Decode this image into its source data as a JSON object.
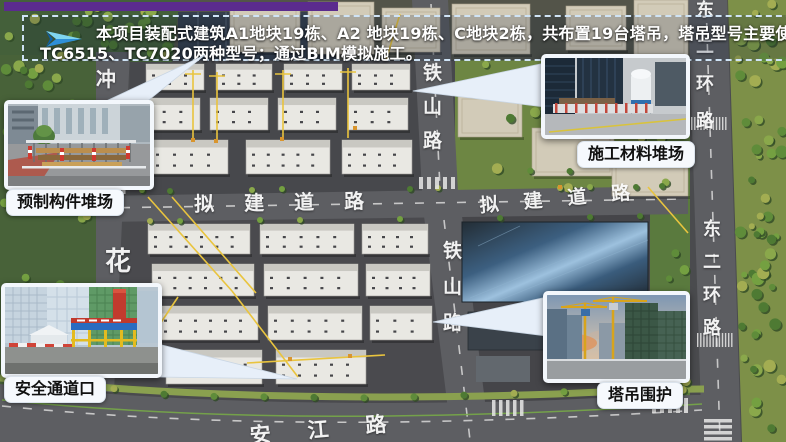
{
  "banner": {
    "icon": "blue-arrow-icon",
    "line1": "本项目装配式建筑A1地块19栋、A2 地块19栋、C地块2栋，共布置19台塔吊，塔吊型号主要使用",
    "line2": "TC6515、TC7020两种型号；通过BIM模拟施工。"
  },
  "callouts": {
    "prefab": {
      "label": "预制构件堆场"
    },
    "material": {
      "label": "施工材料堆场"
    },
    "safety": {
      "label": "安全通道口"
    },
    "crane": {
      "label": "塔吊围护"
    }
  },
  "map": {
    "road_labels": [
      {
        "id": "tieshan-north",
        "text": "铁山路",
        "vertical": true,
        "x": 423,
        "y": 64,
        "dy": 34,
        "size": 19
      },
      {
        "id": "tieshan-south",
        "text": "铁山路",
        "vertical": true,
        "x": 443,
        "y": 242,
        "dy": 36,
        "size": 19
      },
      {
        "id": "nijian-west",
        "text": "拟建道路",
        "vertical": false,
        "x": 194,
        "y": 194,
        "dx": 50,
        "size": 20,
        "rotate": -1
      },
      {
        "id": "nijian-east",
        "text": "拟建道路",
        "vertical": false,
        "x": 479,
        "y": 197,
        "dx": 44,
        "size": 19,
        "rotate": -5
      },
      {
        "id": "dongerhuan-north",
        "text": "东二环路",
        "vertical": true,
        "x": 696,
        "y": 2,
        "dy": 37,
        "size": 18
      },
      {
        "id": "dongerhuan-south",
        "text": "东二环路",
        "vertical": true,
        "x": 703,
        "y": 221,
        "dy": 33,
        "size": 18
      },
      {
        "id": "hua",
        "text": "花",
        "vertical": true,
        "x": 105,
        "y": 249,
        "dy": 0,
        "size": 26
      },
      {
        "id": "chong",
        "text": "冲",
        "vertical": true,
        "x": 96,
        "y": 69,
        "dy": 0,
        "size": 20
      },
      {
        "id": "anjiang",
        "text": "安江路",
        "vertical": false,
        "x": 249,
        "y": 426,
        "dx": 58,
        "size": 21,
        "rotate": -5
      }
    ]
  },
  "colors": {
    "purple_bar": "#5b2b8e",
    "banner_border": "#cfe3f5",
    "banner_text": "#ffffff",
    "callout_label_bg": "#f6f9fd",
    "callout_label_text": "#111111",
    "road_label_text": "#f2f2f2",
    "crane_line": "#e9c43e"
  }
}
